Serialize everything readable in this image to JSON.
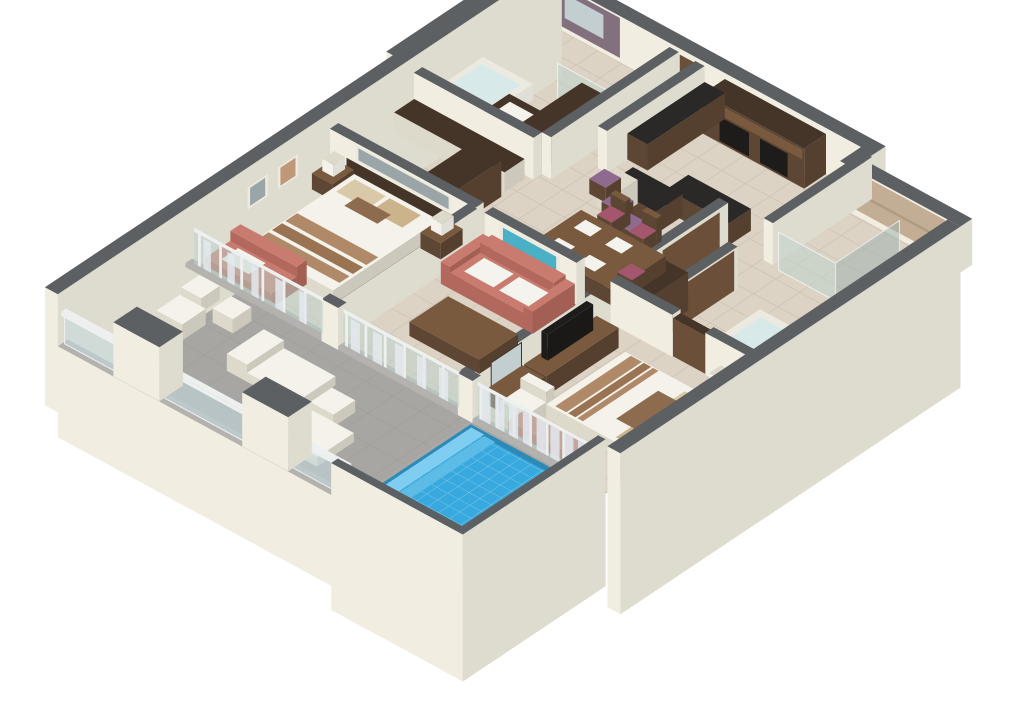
{
  "scene": {
    "description": "3D isometric cutaway floor plan render of a two-bedroom suite with kitchen, living-dining area, two bathrooms, wrap balcony and private plunge pool",
    "view": "axonometric-cutaway",
    "background": "#ffffff",
    "width": 1024,
    "height": 720
  },
  "palette": {
    "bg": "#ffffff",
    "wallTop": "#5d6063",
    "wallFace": "#f1eee1",
    "wallFaceShade": "#e6e2d2",
    "slabEdge": "#b3b2af",
    "floorTile": "#dcd3c4",
    "floorGrout": "#ccc1b1",
    "floorWood": "#8a6a4c",
    "balcFloor": "#a7a6a3",
    "balcLine": "#9b9a97",
    "woodDark": "#5d4634",
    "woodDarker": "#453529",
    "woodTop": "#7a5a3e",
    "doorBrown": "#6b4f38",
    "counterBlack": "#2b2927",
    "appliance": "#1e1c1b",
    "purpleWall": "#83707f",
    "stone": "#c3ae95",
    "stoneLine": "#b09c84",
    "mirror": "#c2ced0",
    "white": "#f4f2ea",
    "whiteShade": "#dedacb",
    "tubWater": "#d8e9ea",
    "coral": "#c87b6e",
    "coralShade": "#b2685c",
    "cushionWhite": "#f4f3ee",
    "pillowTan": "#d9c9a8",
    "pillowTan2": "#cbb38c",
    "pillowBrown": "#8d6b4f",
    "bedStripe": "#b08a68",
    "bedStripe2": "#9a7452",
    "artBlue": "#4ab0c6",
    "artGray": "#9aa5a8",
    "artTerracotta": "#bf9878",
    "frameWhite": "#eceae0",
    "maroon": "#a4566e",
    "stoolPurple": "#8e6b8e",
    "glass": "rgba(188,212,205,0.5)",
    "glassRail": "rgba(196,218,224,0.55)",
    "curtain": "rgba(228,233,239,0.85)",
    "mullion": "#eef0ef",
    "poolBase": "#38a9de",
    "poolLine": "rgba(255,255,255,0.35)",
    "poolStep1": "#7fcdf0",
    "poolStep2": "#5cbce6",
    "poolRim": "#2d89b8"
  },
  "rooms": [
    {
      "name": "second-bedroom",
      "furniture": [
        "queen-bed",
        "two-nightstands",
        "two-lamps",
        "coral-loveseat",
        "headboard-panel",
        "wall-art",
        "framed-pictures",
        "sliding-glass-doors"
      ]
    },
    {
      "name": "bathroom-one",
      "furniture": [
        "bathtub",
        "wood-vanity",
        "glass-shower",
        "wardrobe",
        "mirror",
        "purple-accent-wall"
      ]
    },
    {
      "name": "dressing-area",
      "furniture": [
        "counter",
        "wardrobe"
      ]
    },
    {
      "name": "entry-hall",
      "furniture": [
        "entry-door",
        "wood-floor"
      ]
    },
    {
      "name": "kitchen",
      "furniture": [
        "tall-cabinets",
        "black-appliances",
        "base-cabinets",
        "curved-breakfast-bar",
        "three-purple-bar-stools"
      ]
    },
    {
      "name": "dining-area",
      "furniture": [
        "wood-table",
        "four-place-settings",
        "five-chairs-maroon-cushions"
      ]
    },
    {
      "name": "living-room",
      "furniture": [
        "coral-sofa",
        "white-cushions",
        "blue-wall-art",
        "coffee-table"
      ]
    },
    {
      "name": "hallway-to-master",
      "furniture": [
        "closet-doors",
        "wardrobe"
      ]
    },
    {
      "name": "bathroom-two",
      "furniture": [
        "glass-shower",
        "jetted-tub",
        "stone-accent-wall",
        "closet"
      ]
    },
    {
      "name": "master-bedroom",
      "furniture": [
        "king-bed",
        "striped-runner",
        "headboard",
        "nightstand-lamp",
        "tv-dresser",
        "armchair",
        "desk-mirror",
        "coral-bench",
        "sliding-glass-doors"
      ]
    },
    {
      "name": "balcony",
      "furniture": [
        "white-side-table",
        "two-white-chairs",
        "two-sun-loungers",
        "cube-table",
        "glass-railing",
        "two-pillars"
      ]
    },
    {
      "name": "plunge-pool",
      "furniture": [
        "blue-tiled-pool",
        "steps-ledge",
        "privacy-walls",
        "curtained-glass-doors"
      ]
    }
  ]
}
